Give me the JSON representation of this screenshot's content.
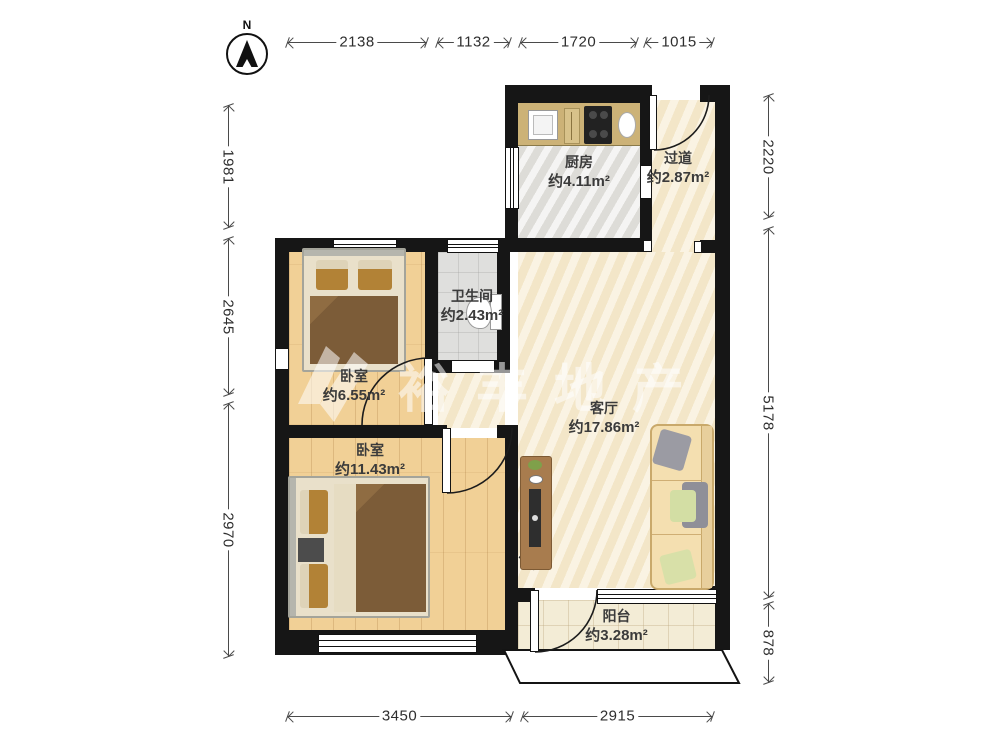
{
  "compass": {
    "label": "N"
  },
  "watermark": {
    "text": "裕丰地产"
  },
  "dimensions": {
    "top": [
      "2138",
      "1132",
      "1720",
      "1015"
    ],
    "left": [
      "1981",
      "2645",
      "2970"
    ],
    "right": [
      "2220",
      "5178",
      "878"
    ],
    "bottom": [
      "3450",
      "2915"
    ]
  },
  "rooms": {
    "kitchen": {
      "name": "厨房",
      "area": "约4.11m²"
    },
    "hallway": {
      "name": "过道",
      "area": "约2.87m²"
    },
    "bathroom": {
      "name": "卫生间",
      "area": "约2.43m²"
    },
    "bedroom_small": {
      "name": "卧室",
      "area": "约6.55m²"
    },
    "bedroom_large": {
      "name": "卧室",
      "area": "约11.43m²"
    },
    "living_room": {
      "name": "客厅",
      "area": "约17.86m²"
    },
    "balcony": {
      "name": "阳台",
      "area": "约3.28m²"
    }
  },
  "colors": {
    "wall": "#161616",
    "wood_floor": "#f1d096",
    "cream_floor": "#f7ecd2",
    "kitchen_floor": "#e8e7e4",
    "bathroom_floor": "#dfdfdd",
    "counter": "#ccb277",
    "blanket": "#7c5c38",
    "sofa": "#f4dfb0",
    "dimension_line": "#4a4a4a"
  }
}
